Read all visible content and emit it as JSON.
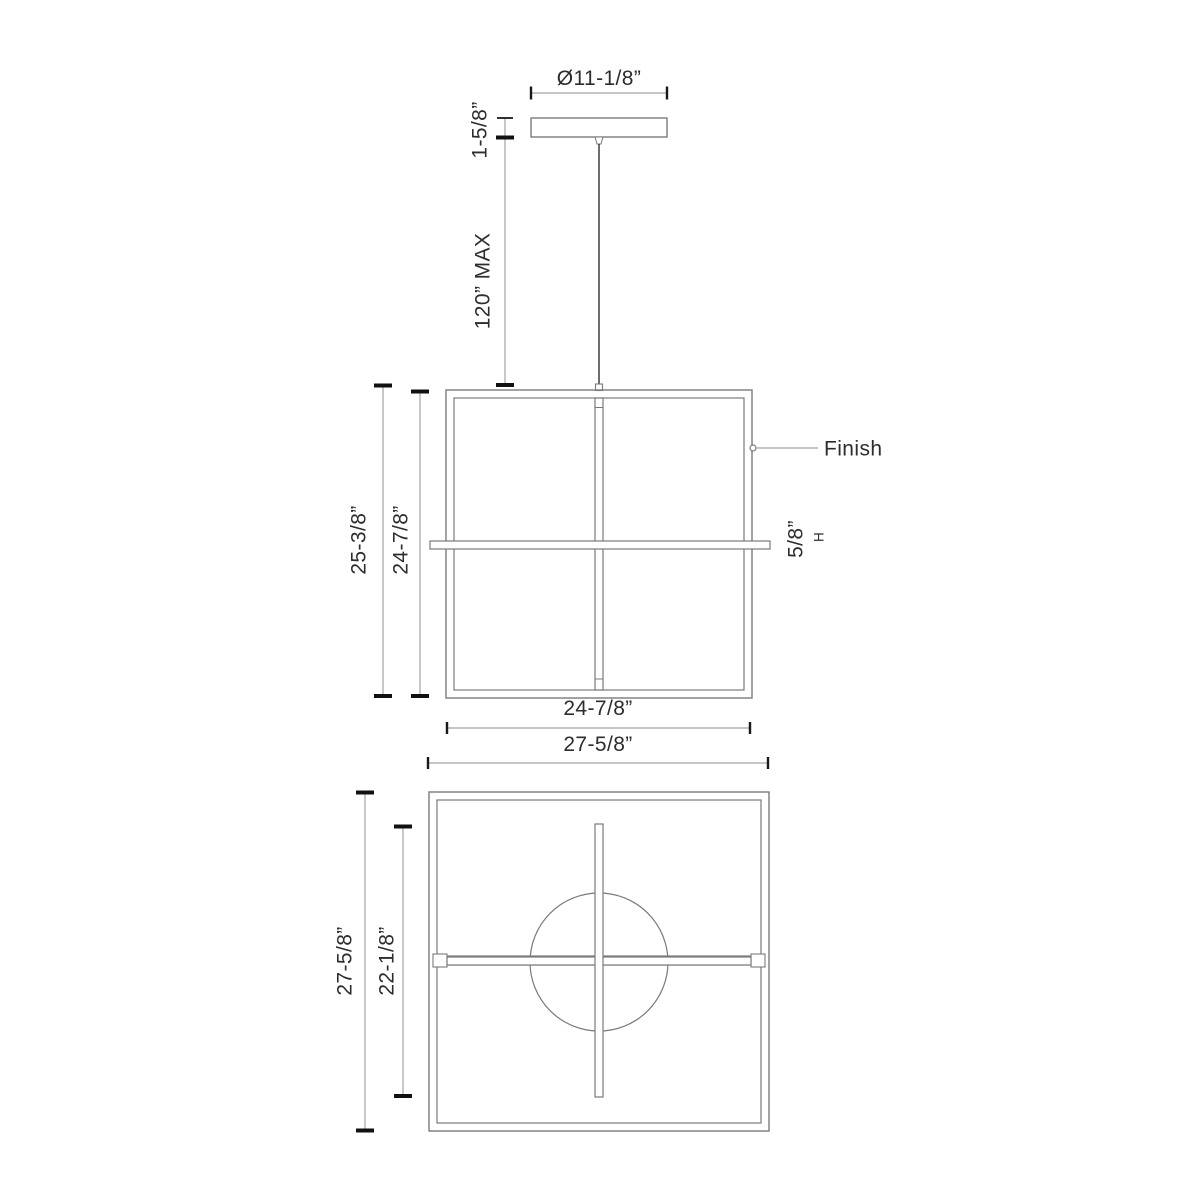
{
  "drawing_type": "pendant-light-fixture-dimension-drawing",
  "colors": {
    "background": "#ffffff",
    "object_line": "#7a7a7a",
    "dimension_line": "#a3a3a3",
    "tick": "#111111",
    "text": "#2d2d2d"
  },
  "views": {
    "canopy": {
      "diameter": "Ø11-1/8”",
      "height": "1-5/8”",
      "cord_max": "120” MAX"
    },
    "front": {
      "overall_height": "25-3/8”",
      "frame_height": "24-7/8”",
      "frame_width": "24-7/8”",
      "bar_width": "27-5/8”",
      "bar_height": "5/8”",
      "bar_height_suffix": "H",
      "finish": "Finish"
    },
    "plan": {
      "overall": "27-5/8”",
      "bar_length": "22-1/8”"
    }
  }
}
